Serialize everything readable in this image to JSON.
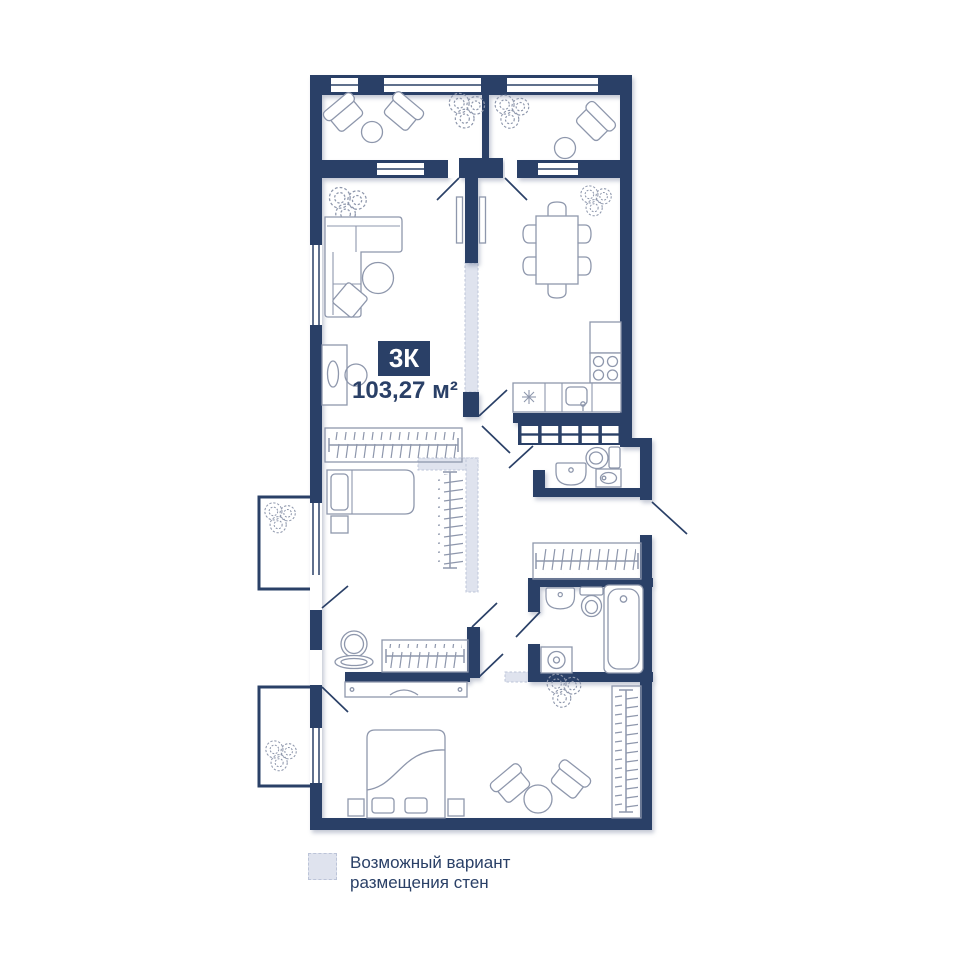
{
  "plan": {
    "type_badge": "3К",
    "area_label": "103,27 м²"
  },
  "legend": {
    "line1": "Возможный вариант",
    "line2": "размещения стен"
  },
  "colors": {
    "wall": "#2a4067",
    "line": "#8e97ac",
    "variant-fill": "#dfe3ee",
    "variant-border": "#bcc4d8",
    "badge-text": "#ffffff",
    "text": "#2a4067",
    "background": "#ffffff"
  },
  "fixtures": [
    "balcony",
    "window",
    "door-swing",
    "variant-wall",
    "ventilation-shaft",
    "sofa",
    "armchair",
    "pouf",
    "cushion",
    "coffee-table",
    "desk",
    "desk-chair",
    "tv-panel",
    "wardrobe",
    "closet-rail",
    "single-bed",
    "double-bed",
    "nightstand",
    "dresser",
    "mirror",
    "dining-table",
    "dining-chair",
    "kitchen-cabinet",
    "stove",
    "kitchen-sink",
    "fridge",
    "bathroom-sink",
    "toilet",
    "washing-machine",
    "bathtub",
    "plant"
  ]
}
